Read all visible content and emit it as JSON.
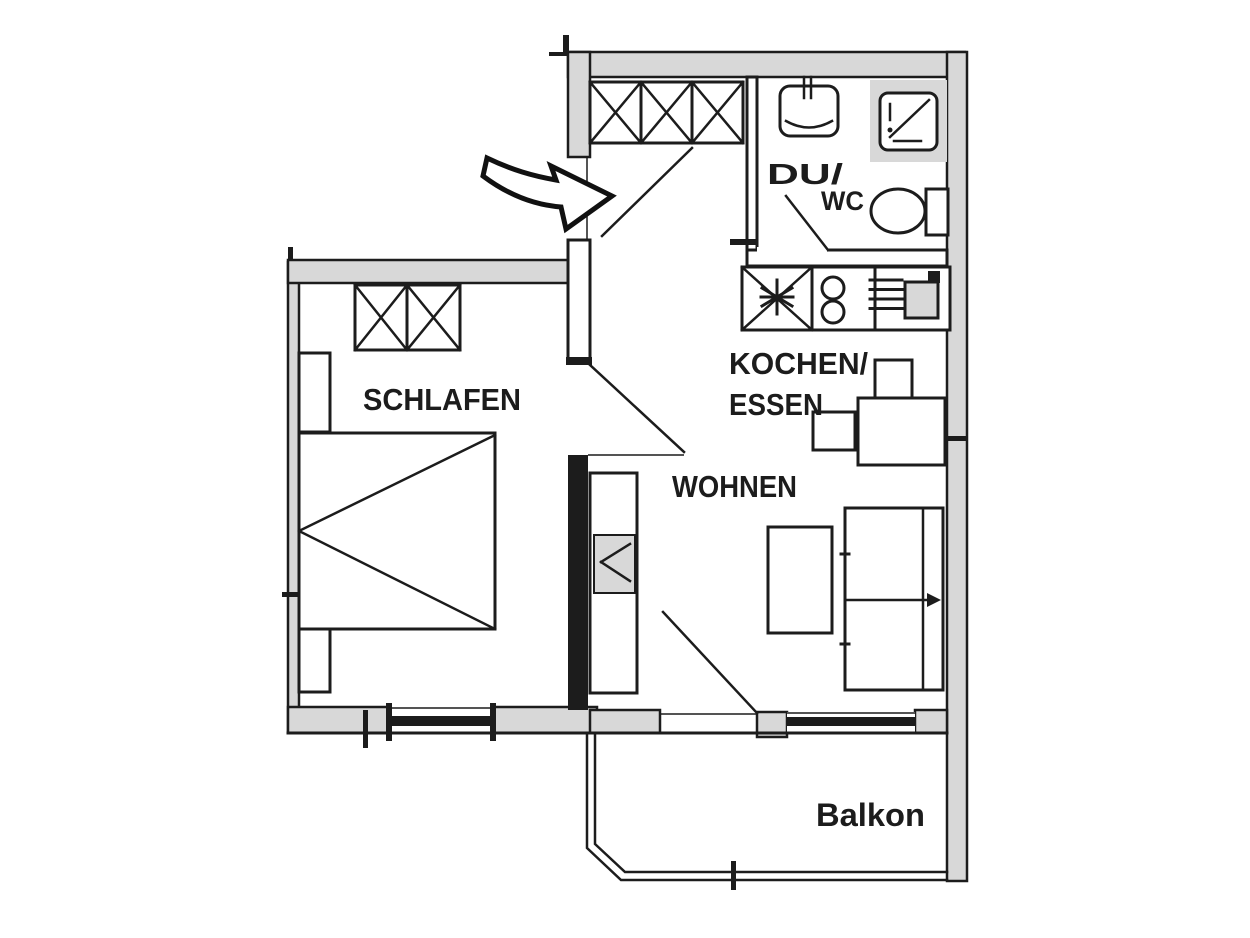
{
  "floorplan": {
    "colors": {
      "background": "#ffffff",
      "line": "#1c1c1c",
      "wall_fill": "#d8d8d8"
    },
    "rooms": {
      "schlafen": {
        "label": "SCHLAFEN"
      },
      "wohnen": {
        "label": "WOHNEN"
      },
      "kochen_essen": {
        "line1": "KOCHEN/",
        "line2": "ESSEN"
      },
      "du_wc": {
        "line1": "DU/",
        "line2": "WC"
      },
      "balkon": {
        "label": "Balkon"
      }
    }
  }
}
